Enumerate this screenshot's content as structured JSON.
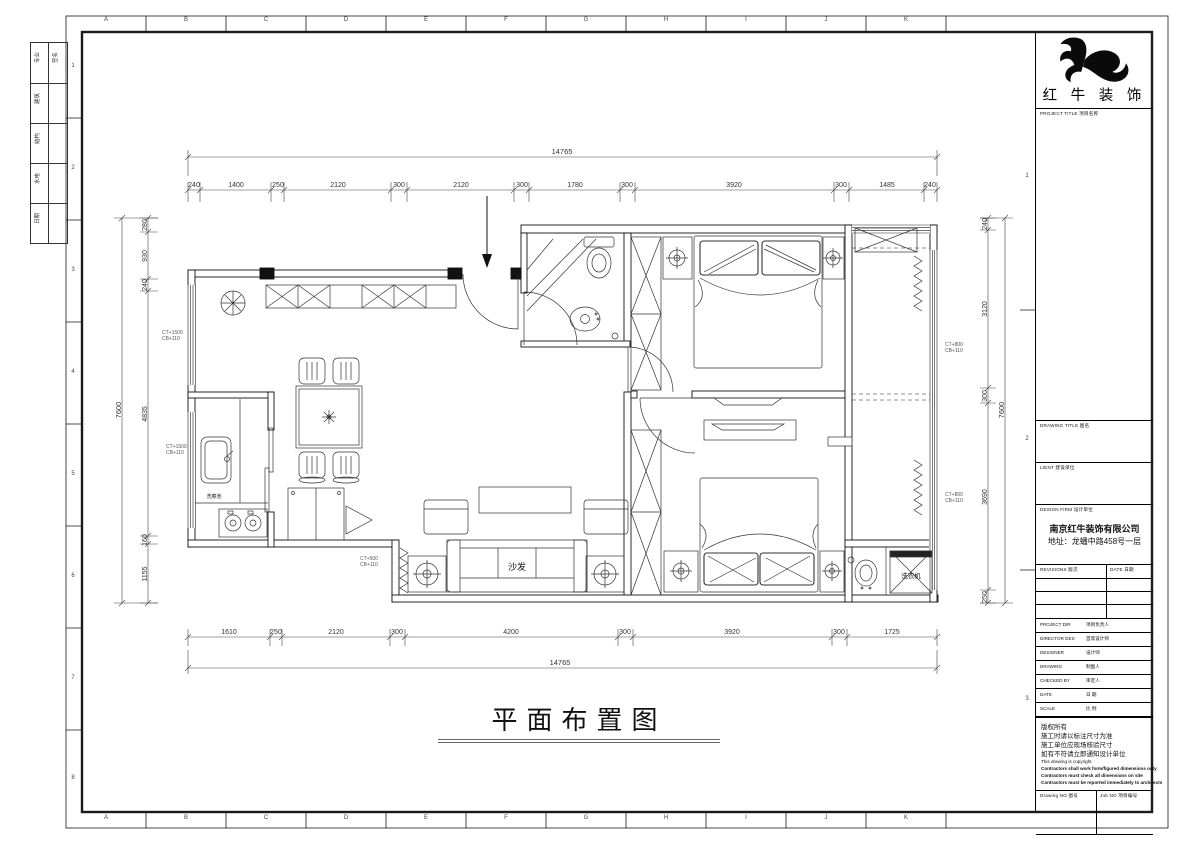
{
  "sheet": {
    "grid_letters": [
      "A",
      "B",
      "C",
      "D",
      "E",
      "F",
      "G",
      "H",
      "I",
      "J",
      "K"
    ],
    "row_numbers_left": [
      "1",
      "2",
      "3",
      "4",
      "5",
      "6",
      "7",
      "8"
    ],
    "row_numbers_right": [
      "1",
      "2",
      "3"
    ],
    "sign_table": {
      "rows": [
        {
          "a": "专业",
          "b": "签名"
        },
        {
          "a": "建筑",
          "b": ""
        },
        {
          "a": "结构",
          "b": ""
        },
        {
          "a": "水电",
          "b": ""
        },
        {
          "a": "日期",
          "b": ""
        }
      ]
    }
  },
  "title_block": {
    "logo_name": "红 牛 装 饰",
    "project_title": "PROJECT TITLE  项目名称",
    "drawing_title": "DRAWING TITLE  图名",
    "client": "LIENT  建设单位",
    "design_firm": "DESIGN FIRM  设计单位",
    "firm_name": "南京红牛装饰有限公司",
    "firm_address": "地址：龙蟠中路458号一层",
    "revisions": "REVISIONS  版次",
    "date_col": "DATE  日期",
    "rows": [
      {
        "en": "PROJECT DIR",
        "cn": "项目负责人"
      },
      {
        "en": "DIRECTOR DES",
        "cn": "首席设计师"
      },
      {
        "en": "DESIGNER",
        "cn": "设计师"
      },
      {
        "en": "DRAWING",
        "cn": "制图人"
      },
      {
        "en": "CHECKED BY",
        "cn": "审定人"
      },
      {
        "en": "DATE",
        "cn": "日  期"
      },
      {
        "en": "SCALE",
        "cn": "比  例"
      }
    ],
    "notes_cn": [
      "版权所有",
      "施工时请以标注尺寸为准",
      "施工单位应现场核验尺寸",
      "如有不符请立即通知设计单位"
    ],
    "notes_en": [
      "This drawing is copyright",
      "Contractors shall work form/figured dimensions only",
      "Contractors must check all dimensions on site",
      "Contractors must be reported immediately to architects"
    ],
    "drawing_no": "Drawing NO  图号",
    "job_no": "Job NO  项目编号"
  },
  "plan": {
    "title": "平面布置图",
    "dims": {
      "top_total": "14765",
      "top": [
        "240",
        "1400",
        "250",
        "2120",
        "300",
        "2120",
        "300",
        "1780",
        "300",
        "3920",
        "300",
        "1485",
        "240"
      ],
      "bottom": [
        "1610",
        "250",
        "2120",
        "300",
        "4200",
        "300",
        "3920",
        "300",
        "1725"
      ],
      "bottom_total": "14765",
      "left": [
        "280",
        "930",
        "240",
        "4835",
        "160",
        "1155"
      ],
      "left_total": "7600",
      "right": [
        "240",
        "3120",
        "300",
        "3690",
        "250"
      ],
      "right_total": "7600"
    },
    "labels": {
      "sofa": "沙发",
      "washer": "洗衣机",
      "sink": "洗菜池"
    },
    "annotations": [
      {
        "l1": "CT+1500",
        "l2": "CB+110"
      },
      {
        "l1": "CT+1500",
        "l2": "CB+110"
      },
      {
        "l1": "CT+500",
        "l2": "CB+110"
      },
      {
        "l1": "CT+800",
        "l2": "CB+110"
      },
      {
        "l1": "CT+800",
        "l2": "CB+110"
      }
    ]
  }
}
